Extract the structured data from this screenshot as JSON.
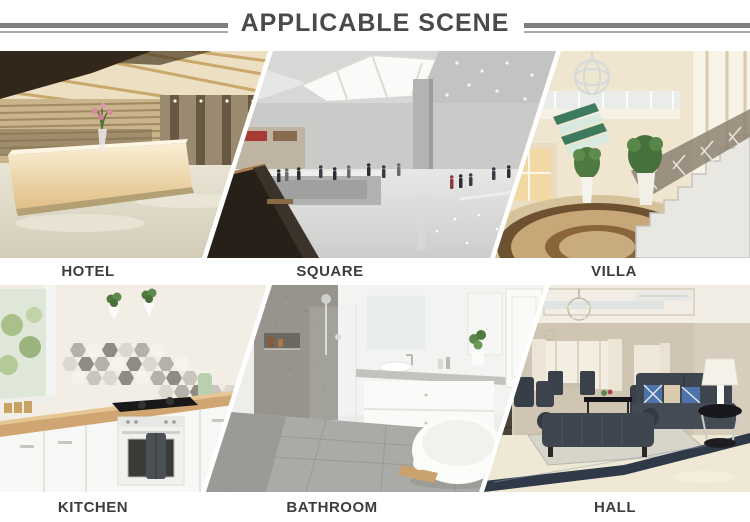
{
  "header": {
    "title": "APPLICABLE SCENE"
  },
  "scenes": [
    {
      "id": "hotel",
      "label": "HOTEL"
    },
    {
      "id": "square",
      "label": "SQUARE"
    },
    {
      "id": "villa",
      "label": "VILLA"
    },
    {
      "id": "kitchen",
      "label": "KITCHEN"
    },
    {
      "id": "bathroom",
      "label": "BATHROOM"
    },
    {
      "id": "hall",
      "label": "HALL"
    }
  ],
  "colors": {
    "background": "#ffffff",
    "title_text": "#4a4a4a",
    "label_text": "#3d3d3d",
    "rule_thick": "#7d7d7d",
    "rule_thin": "#a9a9a9"
  }
}
